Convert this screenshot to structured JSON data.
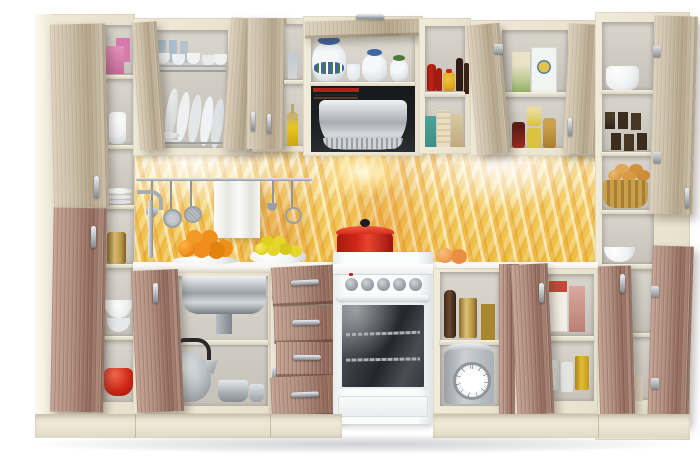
{
  "scene": {
    "type": "product-photo",
    "subject": "Beige modular kitchen set, all cabinet doors and drawers open, light ash upper fronts, dark rose-ash base fronts, wheat-field glass backsplash, white freestanding cooker with range hood"
  },
  "colors": {
    "cream": "#f1ebd9",
    "creamSide": "#e7e0cc",
    "creamDark": "#ded6c0",
    "interiorBack": "#dad6ce",
    "interiorShade": "#c6c2b9",
    "woodLight": "#cdc0a9",
    "woodLightHi": "#dcd1bd",
    "woodLightLo": "#b3a489",
    "woodDark": "#b08e80",
    "woodDarkHi": "#c4a294",
    "woodDarkLo": "#91695a",
    "chrome": "#b9bec5",
    "chromeDark": "#82888f",
    "counter": "#f6f4ed",
    "counterEdge": "#ddd9cd",
    "wheatPale": "#f6eed6",
    "wheatLight": "#f7e7ae",
    "wheatGold": "#f3d269",
    "wheatDeep": "#eec34b",
    "wheatOrange": "#dd8a28",
    "hoodBlack": "#1e2023",
    "hoodSteel": "#aeb2b7",
    "stoveWhite": "#fbfcfc",
    "stoveShade": "#e6e9ea",
    "ovenGlass": "#33363b",
    "ovenGlassHi": "#5b5f66",
    "potRed": "#d02818",
    "potRedDark": "#9c140c",
    "orange": "#ef8e1d",
    "lemon": "#e4d62a",
    "peach": "#f0a257",
    "teapotWhite": "#f5f7f8",
    "teapotBlue": "#3f66a8",
    "teapotGreen": "#4a7a3a",
    "brass": "#b99543",
    "brassHi": "#dcc176",
    "ketchup": "#c42417",
    "mustard": "#e2a81f",
    "soy": "#2e1c12",
    "pinkBox": "#e493bb",
    "tealBox": "#3f8f86",
    "basket": "#c8a04c",
    "scaleSilver": "#ccd0d4",
    "floorShadow": "#d8d8db"
  },
  "items": [
    "wine glasses",
    "tea cups",
    "dinner plates",
    "pink gift boxes",
    "white jug",
    "ceramic tea set",
    "range hood",
    "cook books",
    "olive oil bottle",
    "water glass",
    "ketchup bottle",
    "mustard jar",
    "soy sauce bottles",
    "tea boxes",
    "cereal boxes",
    "jam jars",
    "white casserole pot",
    "tea canisters",
    "bread basket",
    "white bowls",
    "red cast-iron pot",
    "oranges on plate",
    "lemons in bowl",
    "peaches",
    "kitchen towel",
    "hanging ladle",
    "hanging skimmer",
    "hanging strainer",
    "utensil rail",
    "faucet",
    "sink basin",
    "kettle",
    "saucepan",
    "brass canister",
    "bowl stack",
    "small red pot",
    "cutlery drawers",
    "freestanding cooker",
    "oven racks",
    "pepper mill",
    "brass spice canisters",
    "mechanical kitchen scale",
    "food boxes",
    "food cans",
    "storage tins"
  ]
}
